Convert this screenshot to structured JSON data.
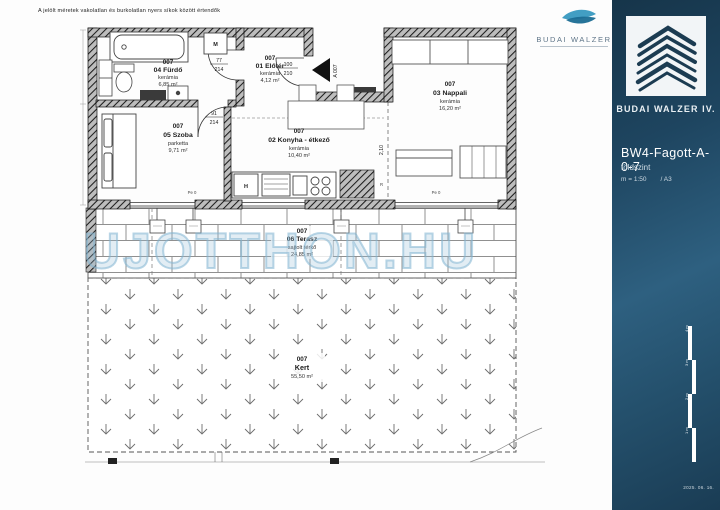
{
  "page": {
    "disclaimer": "A jelölt méretek vakolatlan és burkolatlan nyers síkok között értendők",
    "watermark": "UJOTTHON.HU"
  },
  "top_logo": {
    "brand": "BUDAI WALZER"
  },
  "sidebar": {
    "brand": "BUDAI WALZER IV.",
    "code": "BW4-Fagott-A-0-7",
    "floor": "földszint",
    "scale": "m = 1:50",
    "sheet": "/ A3",
    "date": "2025. 06. 16.",
    "scalebar": [
      "4 m",
      "3 m",
      "2 m",
      "1 m"
    ]
  },
  "rooms": {
    "furdo": {
      "number": "007",
      "name": "04 Fürdő",
      "material": "kerámia",
      "area": "6,85 m²"
    },
    "eloter": {
      "number": "007",
      "name": "01 Előtér",
      "material": "kerámia",
      "area": "4,12 m²"
    },
    "nappali": {
      "number": "007",
      "name": "03 Nappali",
      "material": "kerámia",
      "area": "16,20 m²"
    },
    "szoba": {
      "number": "007",
      "name": "05 Szoba",
      "material": "parketta",
      "area": "9,71 m²"
    },
    "konyha": {
      "number": "007",
      "name": "02 Konyha - étkező",
      "material": "kerámia",
      "area": "10,40 m²"
    },
    "terasz": {
      "number": "007",
      "name": "06 Terasz",
      "material": "sajtolt térkő",
      "area": "24,85 m²"
    },
    "kert": {
      "number": "007",
      "name": "Kert",
      "area": "55,50 m²"
    }
  },
  "annotations": {
    "entrance": "A 007",
    "door_bath_w": "77",
    "door_bath_h": "214",
    "door_entry_w": "100",
    "door_entry_h": "210",
    "door_szoba_w": "91",
    "door_szoba_h": "214",
    "dim_konyha_w": "11,40",
    "dim_opening_h": "2,10",
    "washer": "M",
    "fridge": "H",
    "radiator": "R",
    "marker": "Pe 0"
  }
}
